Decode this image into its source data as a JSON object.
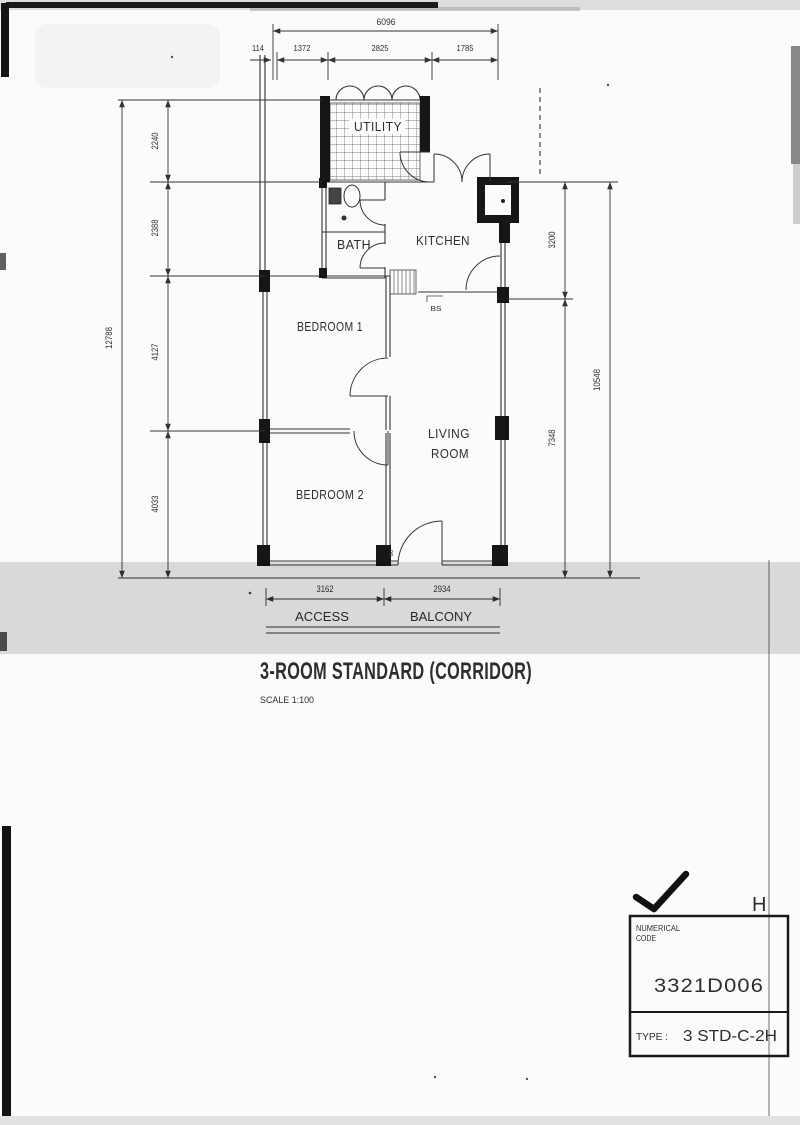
{
  "drawing_title": {
    "name": "3-ROOM STANDARD (CORRIDOR)",
    "scale": "SCALE 1:100"
  },
  "rooms": {
    "utility": "UTILITY",
    "bath": "BATH",
    "kitchen": "KITCHEN",
    "bedroom1": "BEDROOM 1",
    "bedroom2": "BEDROOM 2",
    "living_line1": "LIVING",
    "living_line2": "ROOM"
  },
  "annotations": {
    "access": "ACCESS",
    "balcony": "BALCONY",
    "bs_marker": "BS",
    "door_width": "60"
  },
  "dimensions_mm": {
    "top": {
      "overall": "6096",
      "segments": [
        "114",
        "1372",
        "2825",
        "1785"
      ]
    },
    "left": {
      "overall": "12788",
      "segments": [
        "2240",
        "2388",
        "4127",
        "4033"
      ]
    },
    "right": {
      "overall": "10548",
      "segments": [
        "3200",
        "7348"
      ]
    },
    "bottom": {
      "segments": [
        "3162",
        "2934"
      ]
    }
  },
  "title_block": {
    "header_line1": "NUMERICAL",
    "header_line2": "CODE",
    "numerical_code": "3321D006",
    "type_label": "TYPE :",
    "type_value": "3 STD-C-2H",
    "revision_letter": "H"
  },
  "colors": {
    "line": "#2f2f2f",
    "wall_fill": "#161616",
    "scan_band": "#bdbdbd",
    "paper": "#fbfbfa"
  }
}
